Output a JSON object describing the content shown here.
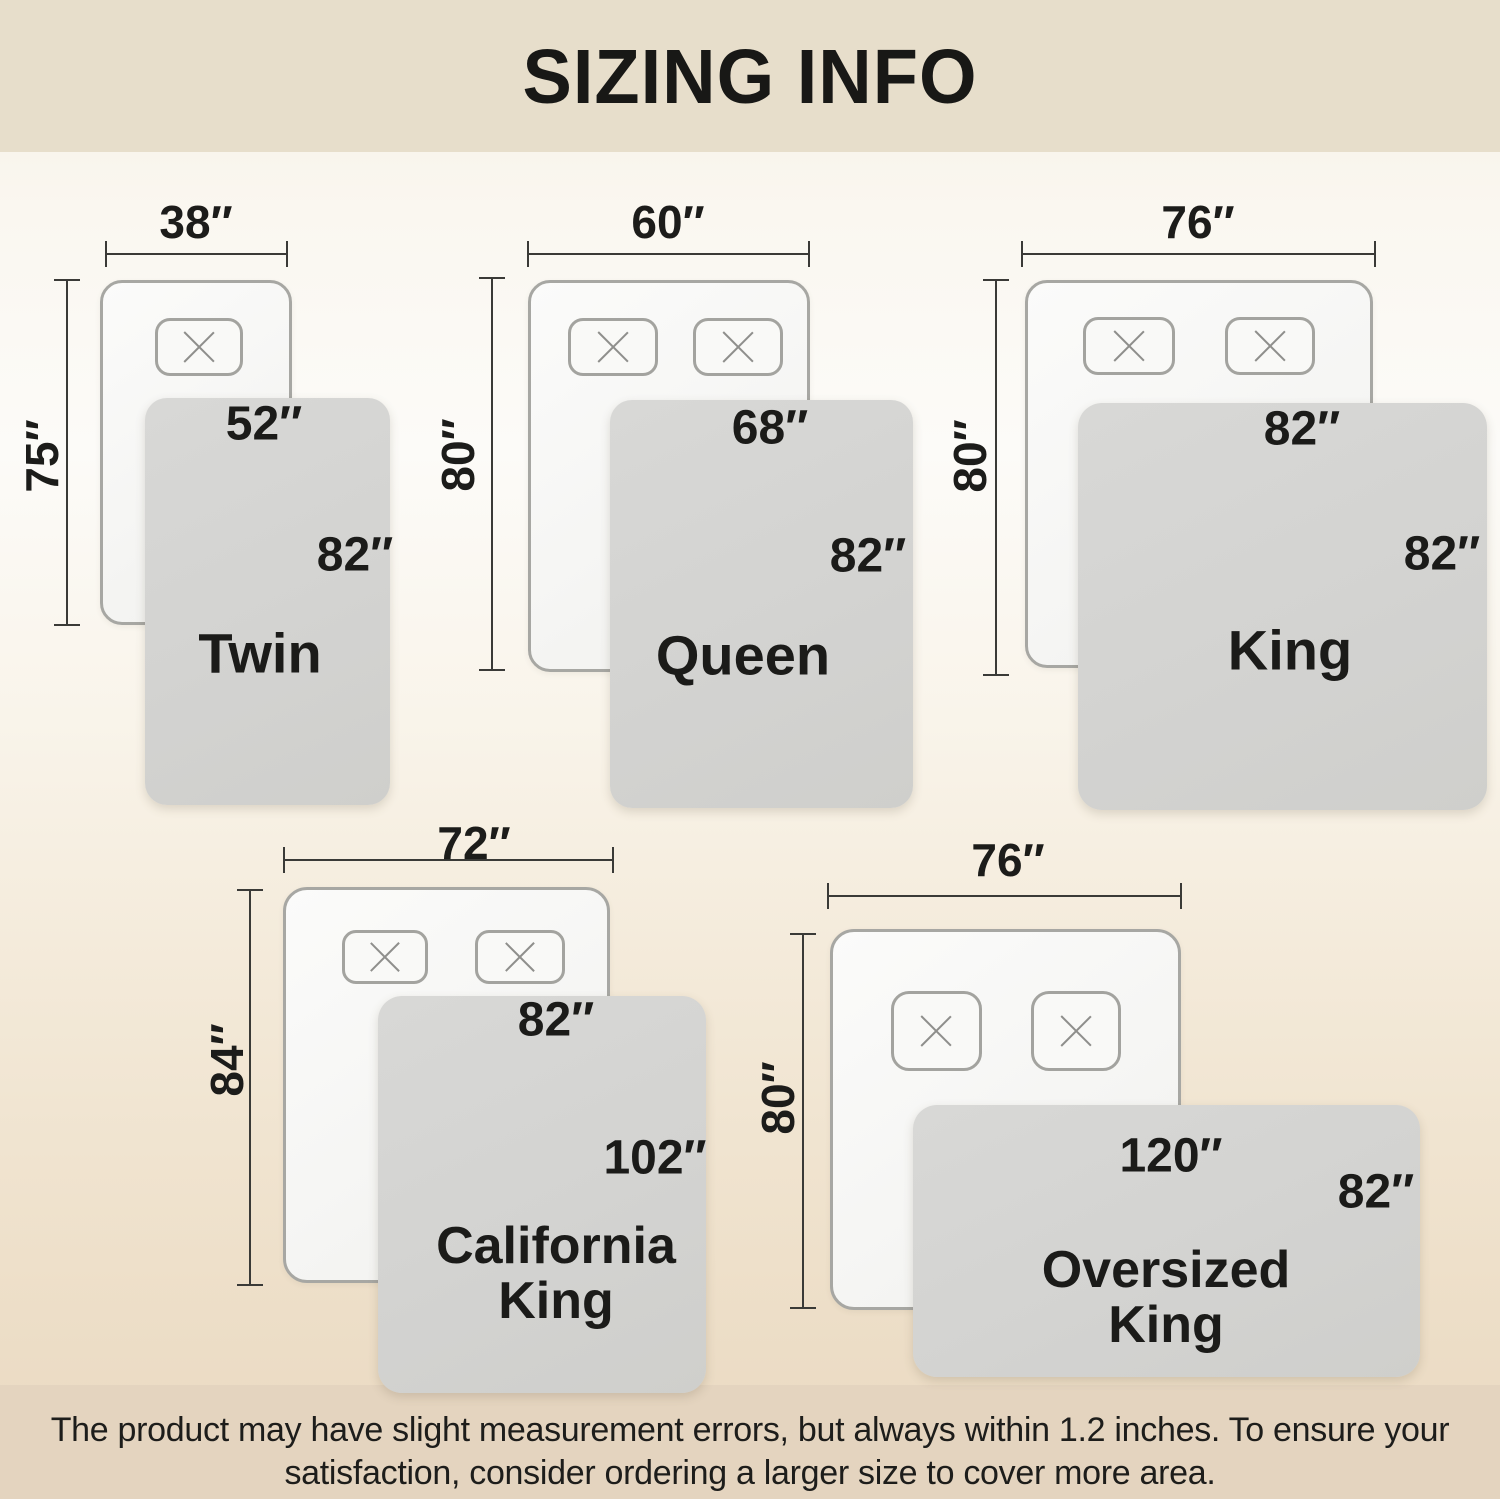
{
  "title": "SIZING INFO",
  "footer": {
    "line1": "The product may have slight measurement errors, but always within 1.2 inches. To ensure your",
    "line2": "satisfaction, consider ordering a larger size to cover more area."
  },
  "colors": {
    "top_band": "#e7decb",
    "bottom_band": "#e4d4bf",
    "blanket_gray": "#d3d3d1",
    "bed_white": "#f7f7f5",
    "outline_gray": "#a7a7a3",
    "dim_line": "#3a3a37",
    "text_black": "#1b1b19"
  },
  "diagrams": [
    {
      "id": "twin",
      "name_lines": [
        "Twin"
      ],
      "bed_width_label": "38″",
      "bed_height_label": "75″",
      "blanket_width_label": "52″",
      "blanket_height_label": "82″",
      "hdim": {
        "y": 254,
        "x1": 106,
        "x2": 287,
        "lcx": 196,
        "lcy": 222
      },
      "vdim": {
        "x": 67,
        "y1": 280,
        "y2": 625,
        "lcx": 42,
        "lcy": 456
      },
      "bed": {
        "x": 100,
        "y": 280,
        "w": 192,
        "h": 345,
        "r": 22
      },
      "pillows": [
        {
          "x": 155,
          "y": 318,
          "w": 88,
          "h": 58,
          "r": 15
        }
      ],
      "blanket": {
        "x": 145,
        "y": 398,
        "w": 245,
        "h": 407,
        "r": 22
      },
      "wlabel": {
        "cx": 264,
        "cy": 424
      },
      "hlabel": {
        "cx": 355,
        "cy": 555
      },
      "name": {
        "cx": 260,
        "cy": 653,
        "size": 56
      }
    },
    {
      "id": "queen",
      "name_lines": [
        "Queen"
      ],
      "bed_width_label": "60″",
      "bed_height_label": "80″",
      "blanket_width_label": "68″",
      "blanket_height_label": "82″",
      "hdim": {
        "y": 254,
        "x1": 528,
        "x2": 809,
        "lcx": 668,
        "lcy": 222
      },
      "vdim": {
        "x": 492,
        "y1": 278,
        "y2": 670,
        "lcx": 458,
        "lcy": 455
      },
      "bed": {
        "x": 528,
        "y": 280,
        "w": 282,
        "h": 392,
        "r": 22
      },
      "pillows": [
        {
          "x": 568,
          "y": 318,
          "w": 90,
          "h": 58,
          "r": 15
        },
        {
          "x": 693,
          "y": 318,
          "w": 90,
          "h": 58,
          "r": 15
        }
      ],
      "blanket": {
        "x": 610,
        "y": 400,
        "w": 303,
        "h": 408,
        "r": 22
      },
      "wlabel": {
        "cx": 770,
        "cy": 428
      },
      "hlabel": {
        "cx": 868,
        "cy": 556
      },
      "name": {
        "cx": 743,
        "cy": 655,
        "size": 56
      }
    },
    {
      "id": "king",
      "name_lines": [
        "King"
      ],
      "bed_width_label": "76″",
      "bed_height_label": "80″",
      "blanket_width_label": "82″",
      "blanket_height_label": "82″",
      "hdim": {
        "y": 254,
        "x1": 1022,
        "x2": 1375,
        "lcx": 1198,
        "lcy": 222
      },
      "vdim": {
        "x": 996,
        "y1": 280,
        "y2": 675,
        "lcx": 970,
        "lcy": 456
      },
      "bed": {
        "x": 1025,
        "y": 280,
        "w": 348,
        "h": 388,
        "r": 22
      },
      "pillows": [
        {
          "x": 1083,
          "y": 317,
          "w": 92,
          "h": 58,
          "r": 15
        },
        {
          "x": 1225,
          "y": 317,
          "w": 90,
          "h": 58,
          "r": 15
        }
      ],
      "blanket": {
        "x": 1078,
        "y": 403,
        "w": 409,
        "h": 407,
        "r": 24
      },
      "wlabel": {
        "cx": 1302,
        "cy": 429
      },
      "hlabel": {
        "cx": 1442,
        "cy": 554
      },
      "name": {
        "cx": 1290,
        "cy": 650,
        "size": 56
      }
    },
    {
      "id": "california-king",
      "name_lines": [
        "California",
        "King"
      ],
      "bed_width_label": "72″",
      "bed_height_label": "84″",
      "blanket_width_label": "82″",
      "blanket_height_label": "102″",
      "hdim": {
        "y": 860,
        "x1": 284,
        "x2": 613,
        "lcx": 474,
        "lcy": 843
      },
      "vdim": {
        "x": 250,
        "y1": 890,
        "y2": 1285,
        "lcx": 227,
        "lcy": 1060
      },
      "bed": {
        "x": 283,
        "y": 887,
        "w": 327,
        "h": 396,
        "r": 24
      },
      "pillows": [
        {
          "x": 342,
          "y": 930,
          "w": 86,
          "h": 54,
          "r": 14
        },
        {
          "x": 475,
          "y": 930,
          "w": 90,
          "h": 54,
          "r": 14
        }
      ],
      "blanket": {
        "x": 378,
        "y": 996,
        "w": 328,
        "h": 397,
        "r": 24
      },
      "wlabel": {
        "cx": 556,
        "cy": 1020
      },
      "hlabel": {
        "cx": 655,
        "cy": 1158
      },
      "name": {
        "cx": 556,
        "cy": 1274,
        "size": 52
      }
    },
    {
      "id": "oversized-king",
      "name_lines": [
        "Oversized",
        "King"
      ],
      "bed_width_label": "76″",
      "bed_height_label": "80″",
      "blanket_width_label": "120″",
      "blanket_height_label": "82″",
      "hdim": {
        "y": 896,
        "x1": 828,
        "x2": 1181,
        "lcx": 1008,
        "lcy": 860
      },
      "vdim": {
        "x": 803,
        "y1": 934,
        "y2": 1308,
        "lcx": 778,
        "lcy": 1098
      },
      "bed": {
        "x": 830,
        "y": 929,
        "w": 351,
        "h": 381,
        "r": 24
      },
      "pillows": [
        {
          "x": 891,
          "y": 991,
          "w": 91,
          "h": 80,
          "r": 18
        },
        {
          "x": 1031,
          "y": 991,
          "w": 90,
          "h": 80,
          "r": 18
        }
      ],
      "blanket": {
        "x": 913,
        "y": 1105,
        "w": 507,
        "h": 272,
        "r": 24
      },
      "wlabel": {
        "cx": 1171,
        "cy": 1156
      },
      "hlabel": {
        "cx": 1376,
        "cy": 1192
      },
      "name": {
        "cx": 1166,
        "cy": 1298,
        "size": 52
      }
    }
  ]
}
